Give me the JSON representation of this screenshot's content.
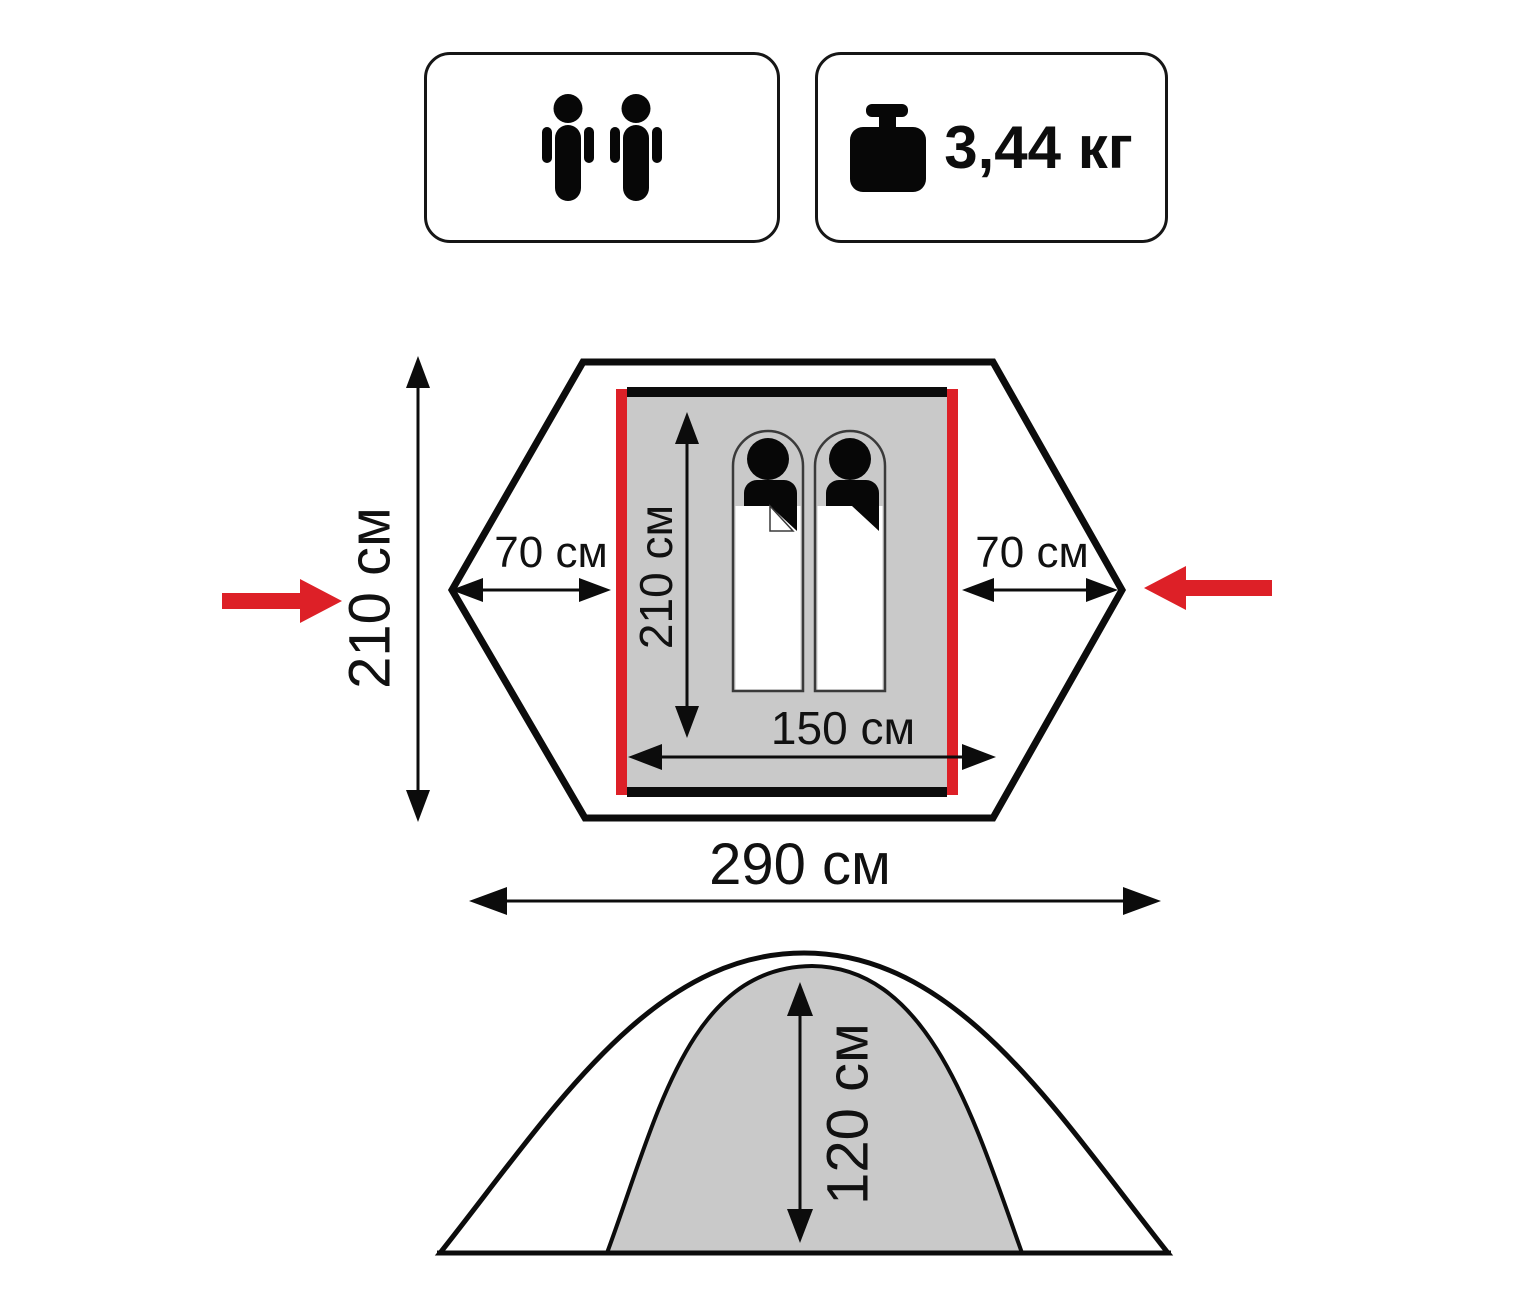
{
  "badges": {
    "capacity": {
      "person_count": 2,
      "icon": "person-icon"
    },
    "weight": {
      "value": "3,44 кг",
      "icon": "weight-icon"
    }
  },
  "top_view": {
    "outer_length": "210 см",
    "outer_width": "290 см",
    "inner_length": "210 см",
    "inner_width": "150 см",
    "vestibule_left": "70 см",
    "vestibule_right": "70 см"
  },
  "side_view": {
    "inner_height": "120 см"
  },
  "colors": {
    "accent_red": "#dd2027",
    "floor_gray": "#c9c9c9",
    "ink": "#111111"
  }
}
